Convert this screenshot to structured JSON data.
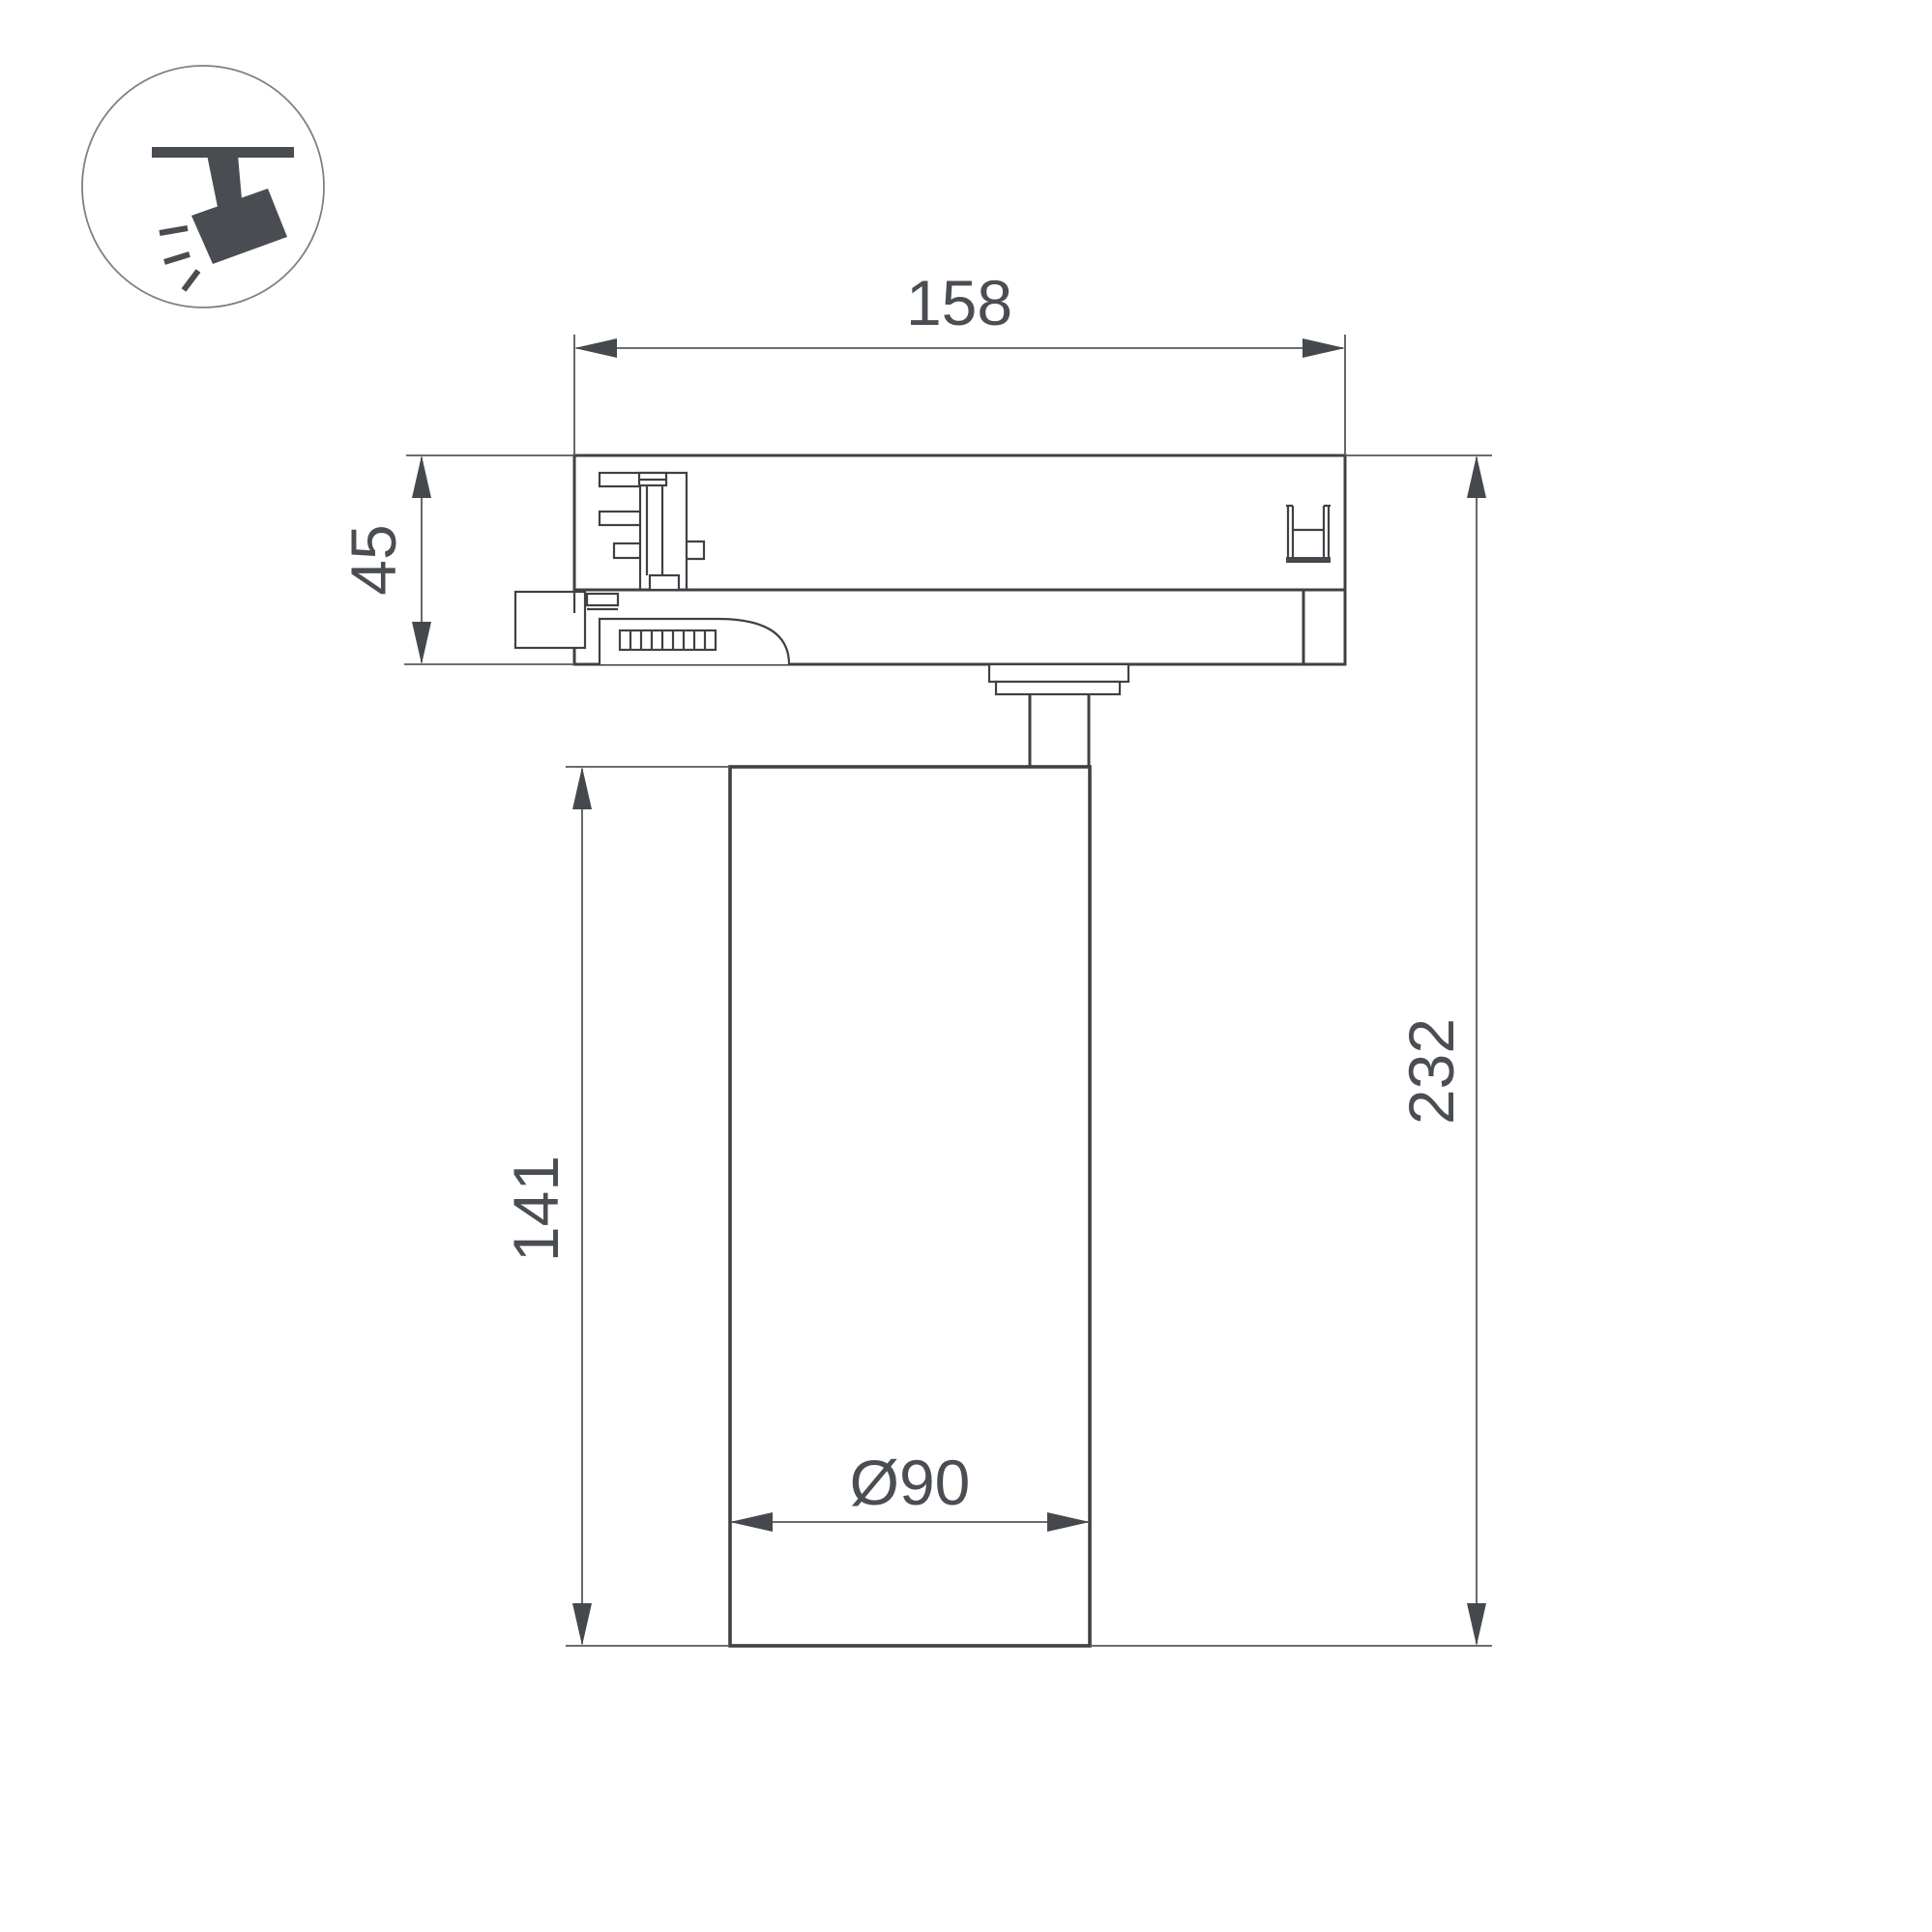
{
  "drawing": {
    "dim_width": "158",
    "dim_adapter_height": "45",
    "dim_body_height": "141",
    "dim_total_height": "232",
    "dim_diameter": "Ø90"
  },
  "icon": {
    "name": "ceiling-track-spotlight-pictogram"
  },
  "colors": {
    "background": "#ffffff",
    "outline": "#3e4145",
    "thin-line": "#55585c",
    "arrow": "#45484d",
    "text": "#4a4d52",
    "icon-fill": "#494d52",
    "icon-circle": "#7d8084"
  }
}
